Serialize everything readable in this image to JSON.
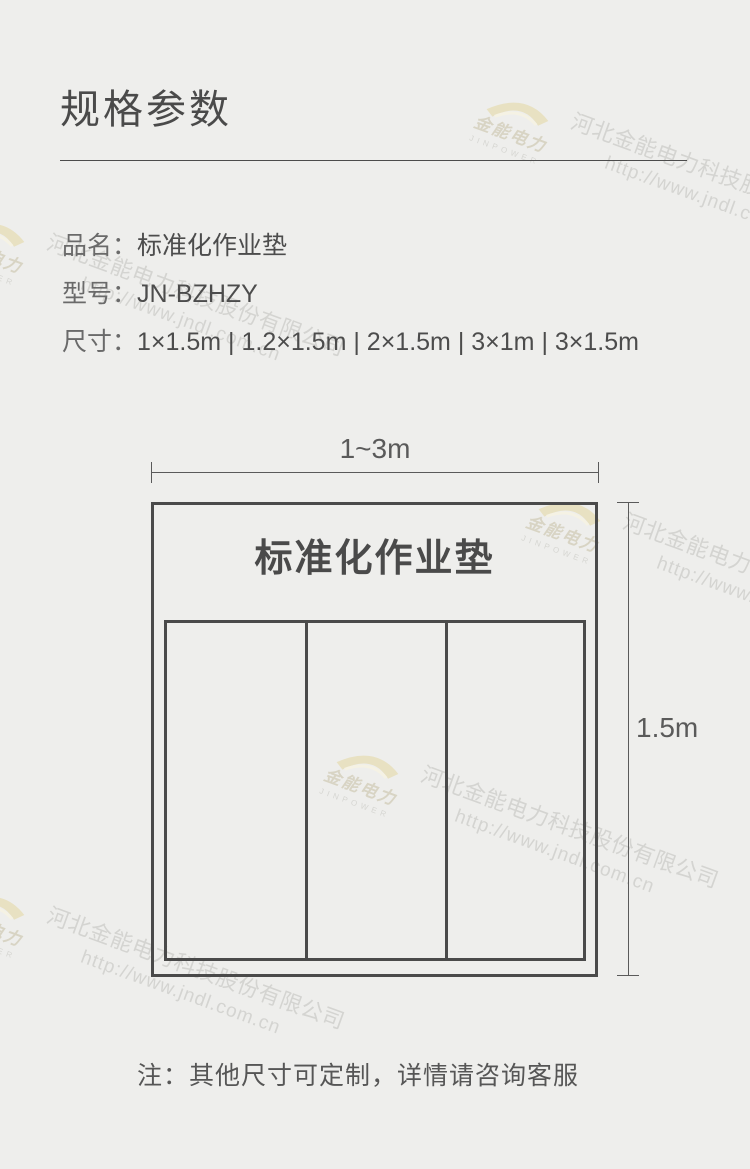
{
  "header": {
    "title": "规格参数"
  },
  "specs": {
    "rows": [
      {
        "label": "品名：",
        "value": "标准化作业垫"
      },
      {
        "label": "型号：",
        "value": "JN-BZHZY"
      },
      {
        "label": "尺寸：",
        "value": "1×1.5m | 1.2×1.5m | 2×1.5m | 3×1m | 3×1.5m"
      }
    ]
  },
  "diagram": {
    "mat_label": "标准化作业垫",
    "width_label": "1~3m",
    "height_label": "1.5m",
    "columns": 3
  },
  "note": "注：其他尺寸可定制，详情请咨询客服",
  "watermark": {
    "logo_cn": "金能电力",
    "logo_en": "JINPOWER",
    "company": "河北金能电力科技股份有限公司",
    "url": "http://www.jndl.com.cn"
  },
  "colors": {
    "background": "#eeeeec",
    "ink": "#4a4a4a",
    "dim_line": "#5a5a5a",
    "watermark_gray": "#d4d4d1",
    "watermark_gold": "#e8e1c2"
  }
}
